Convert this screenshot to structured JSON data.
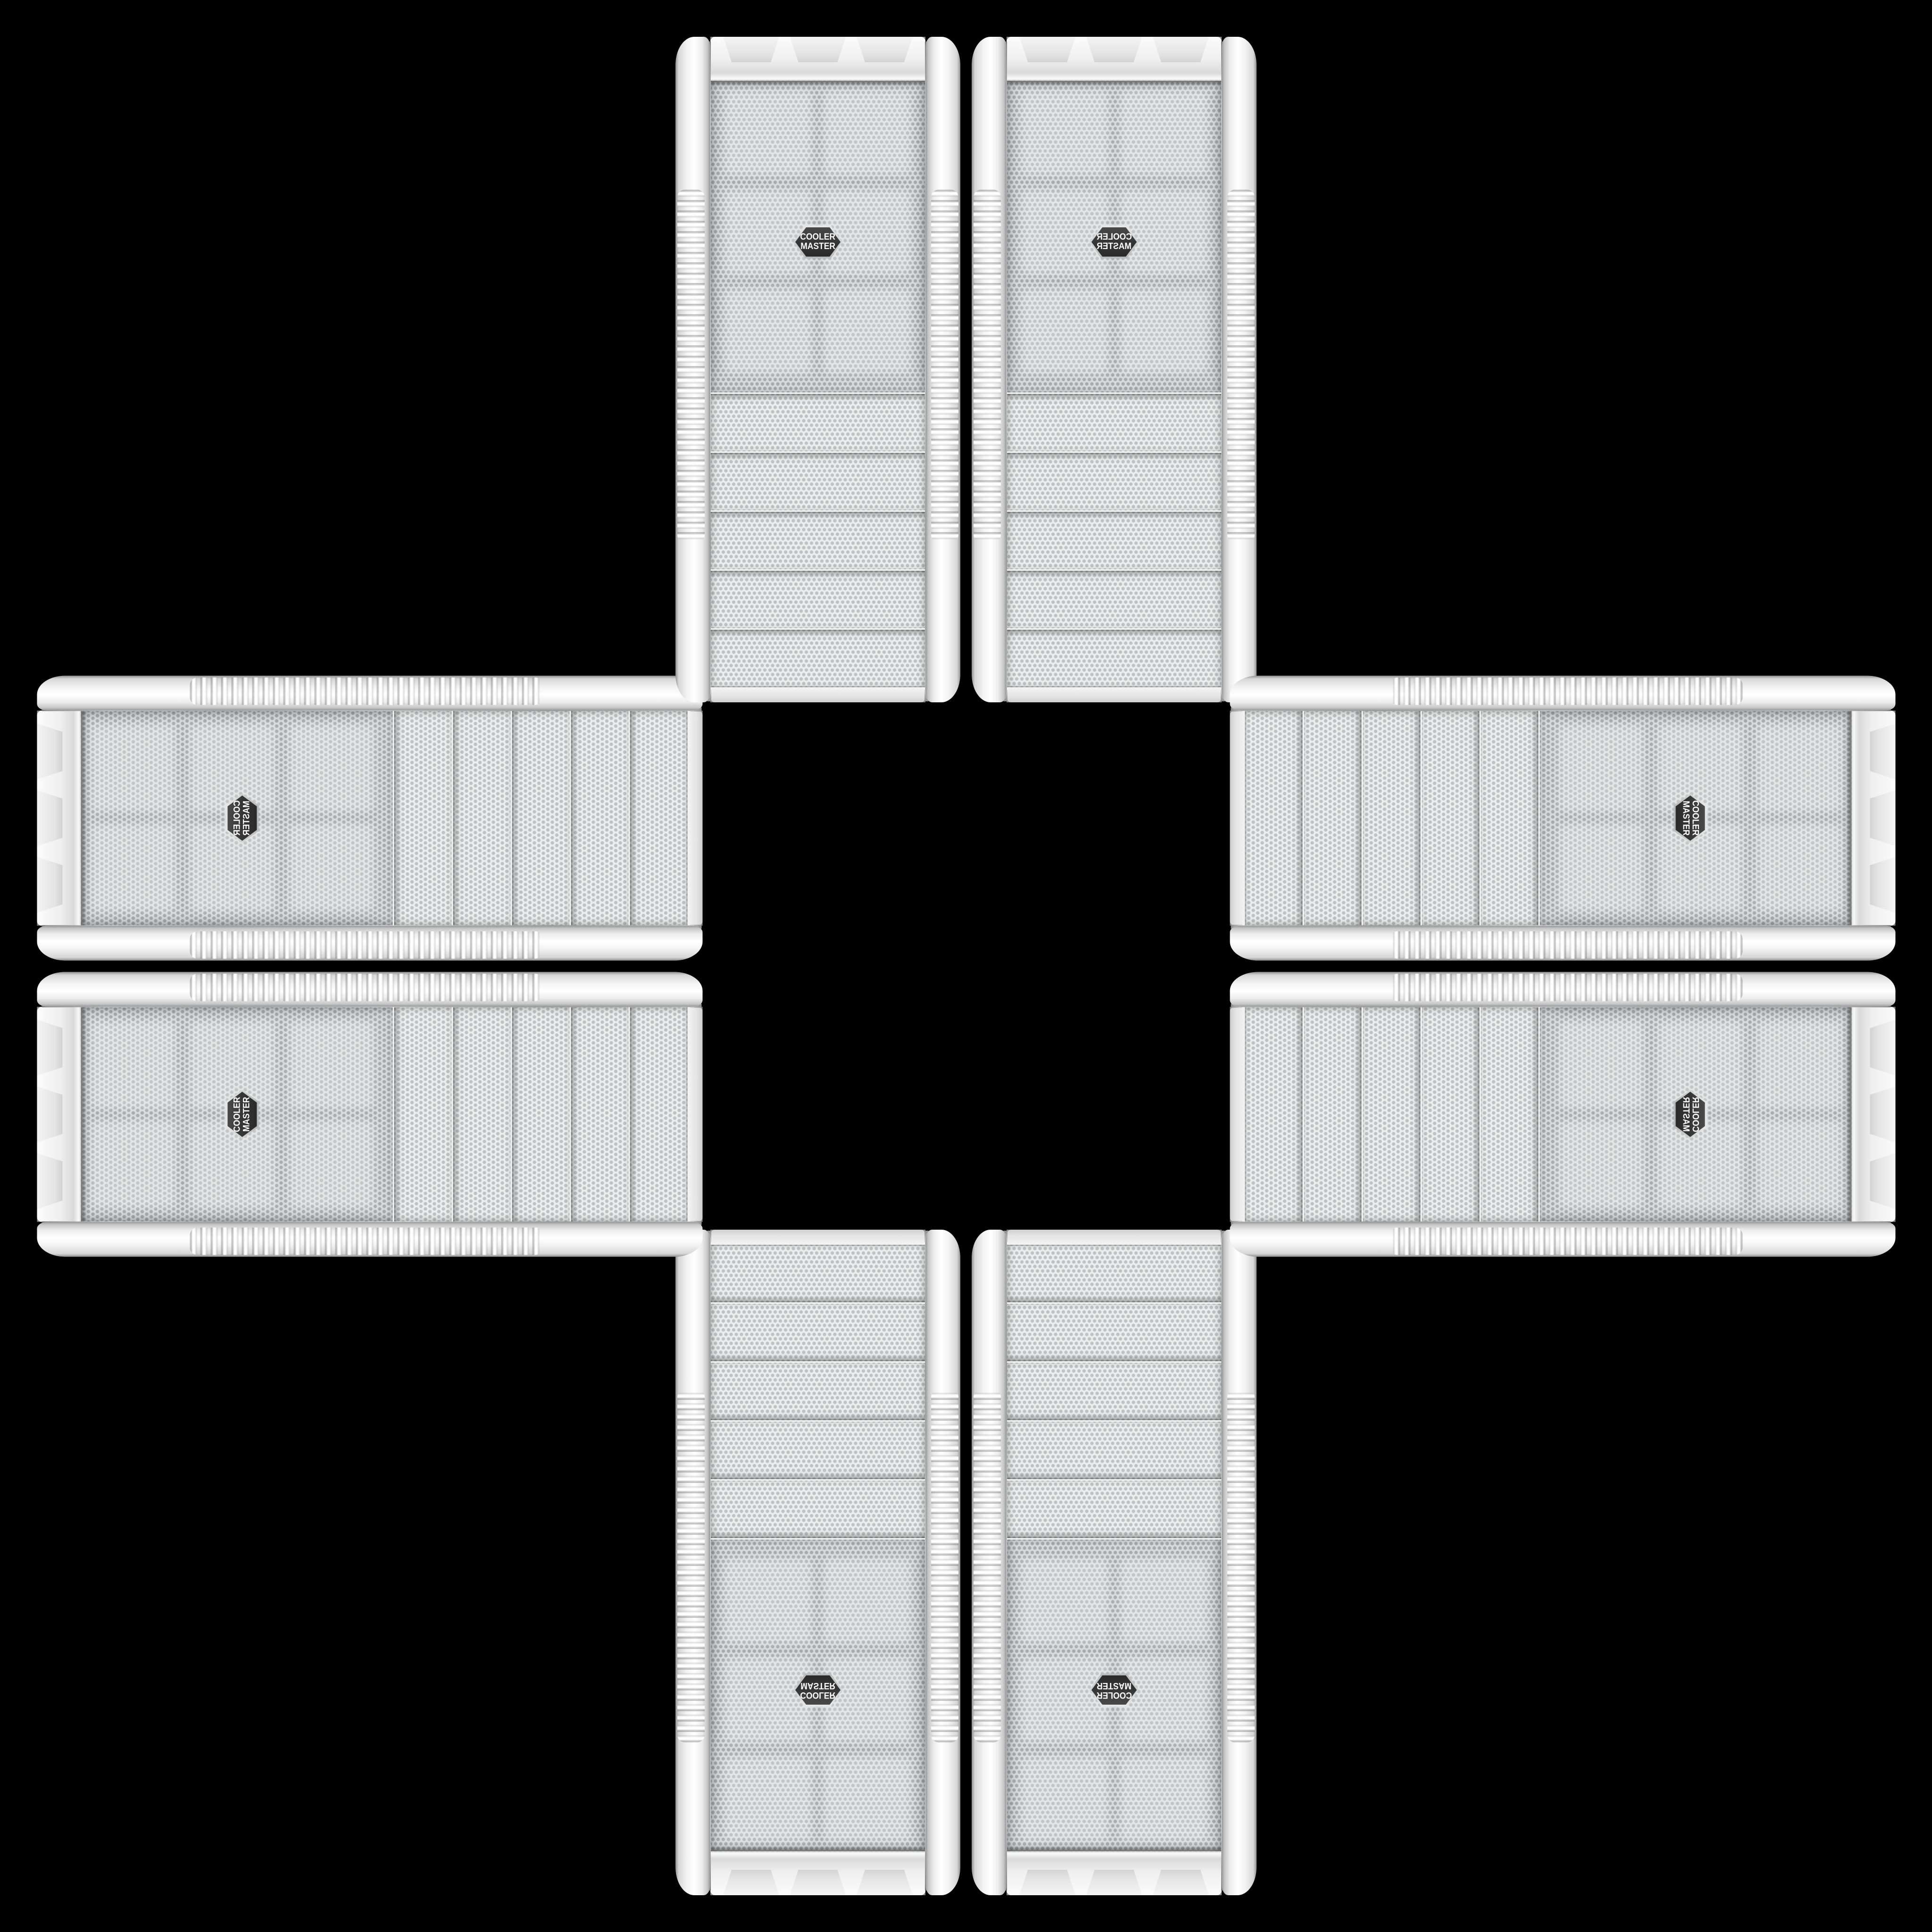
{
  "scene": {
    "description": "Eight white Cooler Master PC tower front panels arranged in a plus/cross pattern on a black background; mirrored and rotated copies with mesh fan grille and brand badge facing outward, drive-bay covers facing the empty center",
    "background_color": "#000000"
  },
  "badge": {
    "line1": "COOLER",
    "line2": "MASTER",
    "shape": "hexagon",
    "bg_color": "#343434",
    "rim_color": "#d9d9d9",
    "text_color": "#ffffff"
  },
  "case_appearance": {
    "body_color": "#f2f2f2",
    "mesh_color": "#d6d8d9",
    "mesh_dot_color": "#a7a9ab",
    "bay_mesh_color": "#ebecec",
    "chrome_color": "#b5b5b5",
    "drive_bay_count": 5
  },
  "cases": [
    {
      "id": "top-left",
      "orientation": "vertical, rotated 180°, badge upside-down, bays toward center"
    },
    {
      "id": "top-right",
      "orientation": "vertical, mirrored copy of top-left"
    },
    {
      "id": "bottom-left",
      "orientation": "vertical, horizontally mirrored, bays toward center"
    },
    {
      "id": "bottom-right",
      "orientation": "vertical, upright readable badge, bays toward center"
    },
    {
      "id": "left-top",
      "orientation": "horizontal, badge at outer left, bays toward center"
    },
    {
      "id": "left-bottom",
      "orientation": "horizontal, mirrored copy of left-top"
    },
    {
      "id": "right-top",
      "orientation": "horizontal, badge at outer right, bays toward center"
    },
    {
      "id": "right-bottom",
      "orientation": "horizontal, mirrored copy of right-top"
    }
  ]
}
